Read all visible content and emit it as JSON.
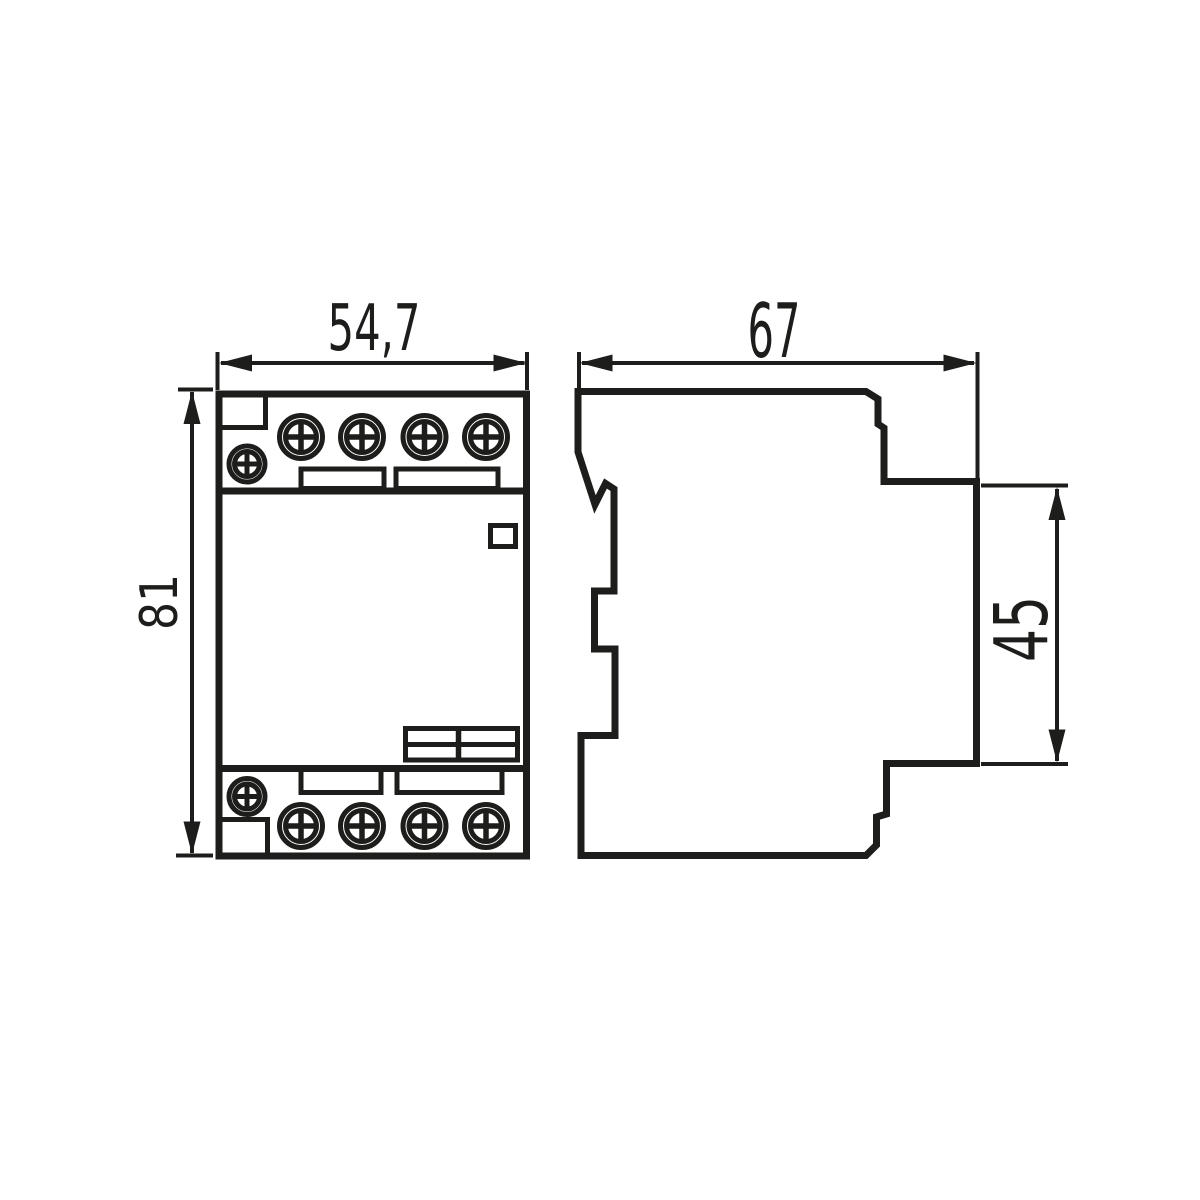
{
  "drawing": {
    "background_color": "#ffffff",
    "line_color": "#1d1d1b",
    "front_view": {
      "width_label": "54,7",
      "height_label": "81",
      "terminal_screws_top": 4,
      "terminal_screws_bottom": 4,
      "small_screws": 2
    },
    "side_view": {
      "depth_label": "67",
      "rear_block_height_label": "45"
    }
  }
}
